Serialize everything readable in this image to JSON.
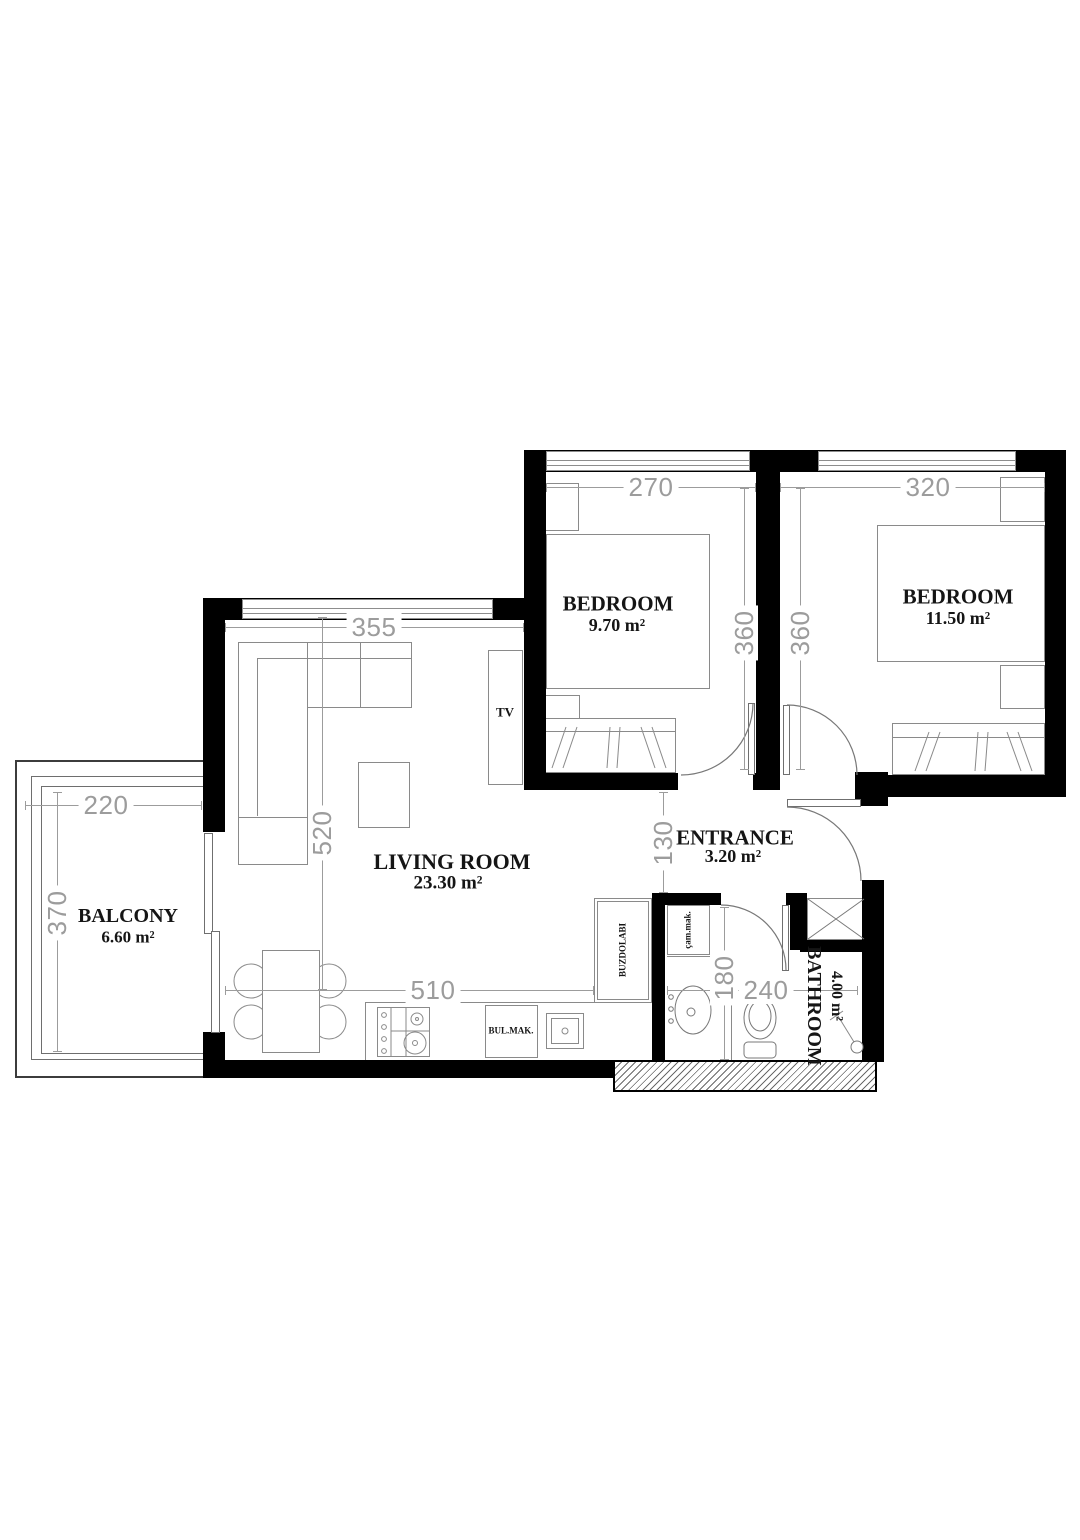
{
  "plan": {
    "title": "Apartment floor plan",
    "rooms": [
      {
        "name": "BEDROOM",
        "area": "9.70 m²"
      },
      {
        "name": "BEDROOM",
        "area": "11.50 m²"
      },
      {
        "name": "LIVING ROOM",
        "area": "23.30 m²"
      },
      {
        "name": "ENTRANCE",
        "area": "3.20 m²"
      },
      {
        "name": "BATHROOM",
        "area": "4.00 m²"
      },
      {
        "name": "BALCONY",
        "area": "6.60 m²"
      }
    ],
    "dims": {
      "br1_w": "270",
      "br2_w": "320",
      "br1_h": "360",
      "br2_h": "360",
      "lr_w": "355",
      "lr_h": "520",
      "kitchen_w": "510",
      "hall_h": "130",
      "bath_h": "180",
      "bath_w": "240",
      "bal_w": "220",
      "bal_h": "370"
    },
    "appliances": {
      "tv": "TV",
      "dishwasher": "BUL.MAK.",
      "fridge": "BUZDOLABI",
      "washer": "çam.mak."
    },
    "colors": {
      "wall": "#000000",
      "dim": "#9c9c9c",
      "furniture": "#8a8a8a",
      "text": "#151515"
    }
  }
}
